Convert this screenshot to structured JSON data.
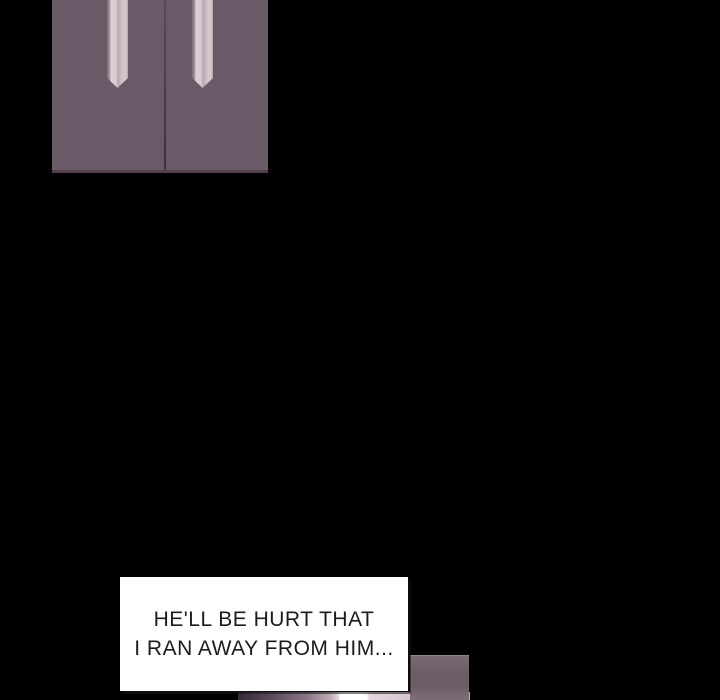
{
  "scene": {
    "background_color": "#000000"
  },
  "closet_panel": {
    "door_color": "#6a5a67",
    "seam_color": "#463746",
    "bottom_edge_color": "#53424c",
    "drawstring_light_color": "#d8ccd1",
    "drawstring_shadow_color": "#8d7d87"
  },
  "next_panel": {
    "wall_color": "#6e5d68",
    "edge_highlight_color": "#958692",
    "strip_highlight_color": "#ffffff",
    "strip_dark_color": "#342a36"
  },
  "speech_bubble": {
    "fill_color": "#ffffff",
    "text_color": "#1c1c1c",
    "lines": [
      "HE'LL BE HURT THAT",
      "I RAN AWAY FROM HIM..."
    ]
  }
}
